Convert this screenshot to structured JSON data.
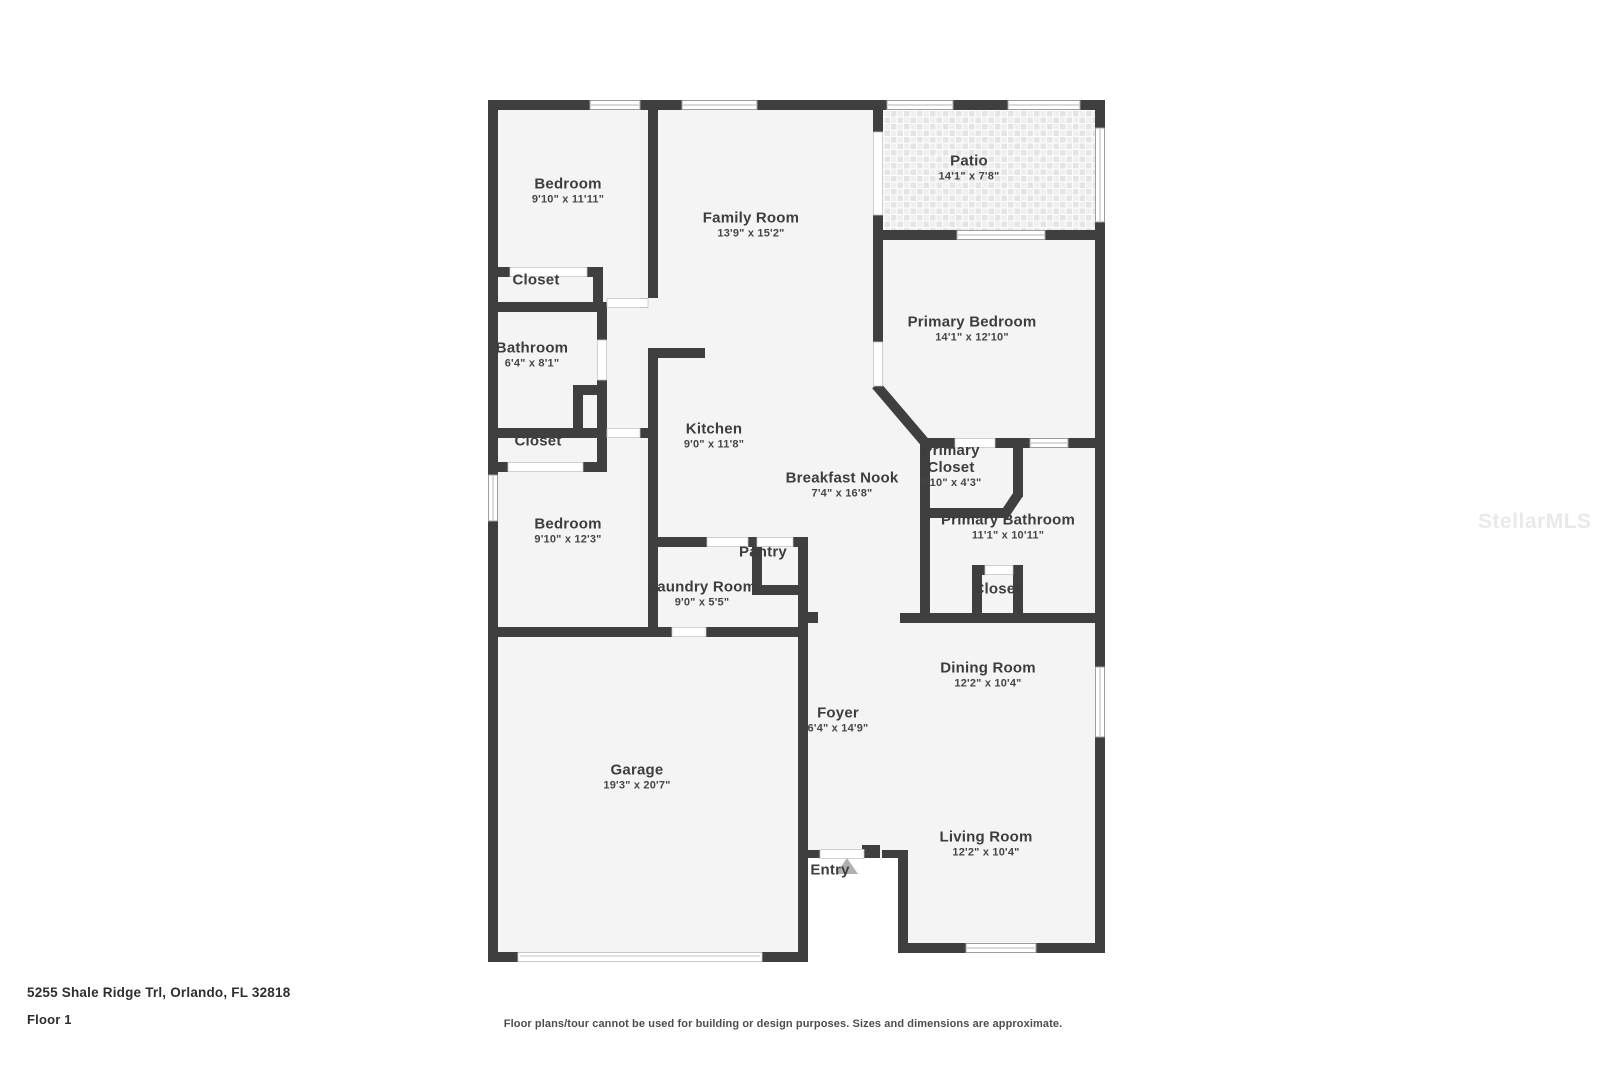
{
  "page": {
    "address": "5255 Shale Ridge Trl, Orlando, FL 32818",
    "floor_label": "Floor 1",
    "disclaimer": "Floor plans/tour cannot be used for building or design purposes. Sizes and dimensions are approximate.",
    "watermark": "StellarMLS"
  },
  "colors": {
    "wall": "#3f3f3f",
    "floor": "#f4f4f4",
    "patio_tile": "#e4e4e4",
    "entry_arrow": "#b0b0b0"
  },
  "rooms": [
    {
      "name": "Bedroom",
      "dims": "9'10\" x 11'11\""
    },
    {
      "name": "Family Room",
      "dims": "13'9\" x 15'2\""
    },
    {
      "name": "Patio",
      "dims": "14'1\" x 7'8\""
    },
    {
      "name": "Primary Bedroom",
      "dims": "14'1\" x 12'10\""
    },
    {
      "name": "Closet",
      "dims": ""
    },
    {
      "name": "Bathroom",
      "dims": "6'4\" x 8'1\""
    },
    {
      "name": "Kitchen",
      "dims": "9'0\" x 11'8\""
    },
    {
      "name": "Breakfast Nook",
      "dims": "7'4\" x 16'8\""
    },
    {
      "name": "Primary Closet",
      "dims": "5'10\" x 4'3\""
    },
    {
      "name": "Primary Bathroom",
      "dims": "11'1\" x 10'11\""
    },
    {
      "name": "Closet",
      "dims": ""
    },
    {
      "name": "Bedroom",
      "dims": "9'10\" x 12'3\""
    },
    {
      "name": "Pantry",
      "dims": ""
    },
    {
      "name": "Laundry Room",
      "dims": "9'0\" x 5'5\""
    },
    {
      "name": "Closet",
      "dims": ""
    },
    {
      "name": "Dining Room",
      "dims": "12'2\" x 10'4\""
    },
    {
      "name": "Foyer",
      "dims": "6'4\" x 14'9\""
    },
    {
      "name": "Garage",
      "dims": "19'3\" x 20'7\""
    },
    {
      "name": "Living Room",
      "dims": "12'2\" x 10'4\""
    },
    {
      "name": "Entry",
      "dims": ""
    }
  ]
}
